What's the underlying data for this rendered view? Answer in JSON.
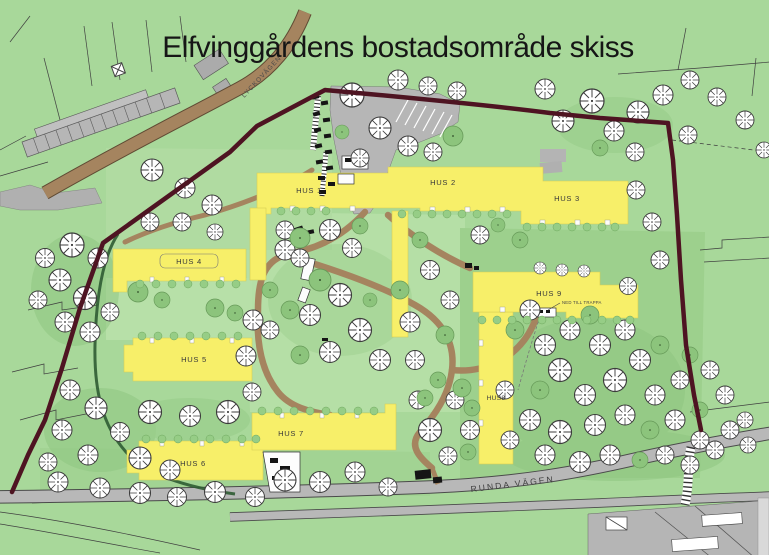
{
  "title": "Elfvinggårdens bostadsområde skiss",
  "roads": {
    "lyckovagen": "LYCKOVÄGEN",
    "runda_vagen": "RUNDA VÄGEN"
  },
  "buildings": [
    {
      "id": "hus-1",
      "label": "HUS 1"
    },
    {
      "id": "hus-2",
      "label": "HUS 2"
    },
    {
      "id": "hus-3",
      "label": "HUS 3"
    },
    {
      "id": "hus-4",
      "label": "HUS 4"
    },
    {
      "id": "hus-5",
      "label": "HUS 5"
    },
    {
      "id": "hus-6",
      "label": "HUS 6"
    },
    {
      "id": "hus-7",
      "label": "HUS 7"
    },
    {
      "id": "hus-8",
      "label": "HUS8"
    },
    {
      "id": "hus-9",
      "label": "HUS 9"
    }
  ],
  "annotations": {
    "hus9_note": "NED TILL TRAPPA"
  },
  "colors": {
    "background_green": "#a8d89a",
    "courtyard_green": "#b5dfa6",
    "tree_green": "#8cc47c",
    "hedge_dark_green": "#2f5c33",
    "building_yellow": "#f7ef69",
    "boundary_maroon": "#4e1422",
    "road_gray": "#b8b8b8",
    "road_edge_gray": "#4a4a4a",
    "path_brown": "#a5845f",
    "title_black": "#161616"
  }
}
